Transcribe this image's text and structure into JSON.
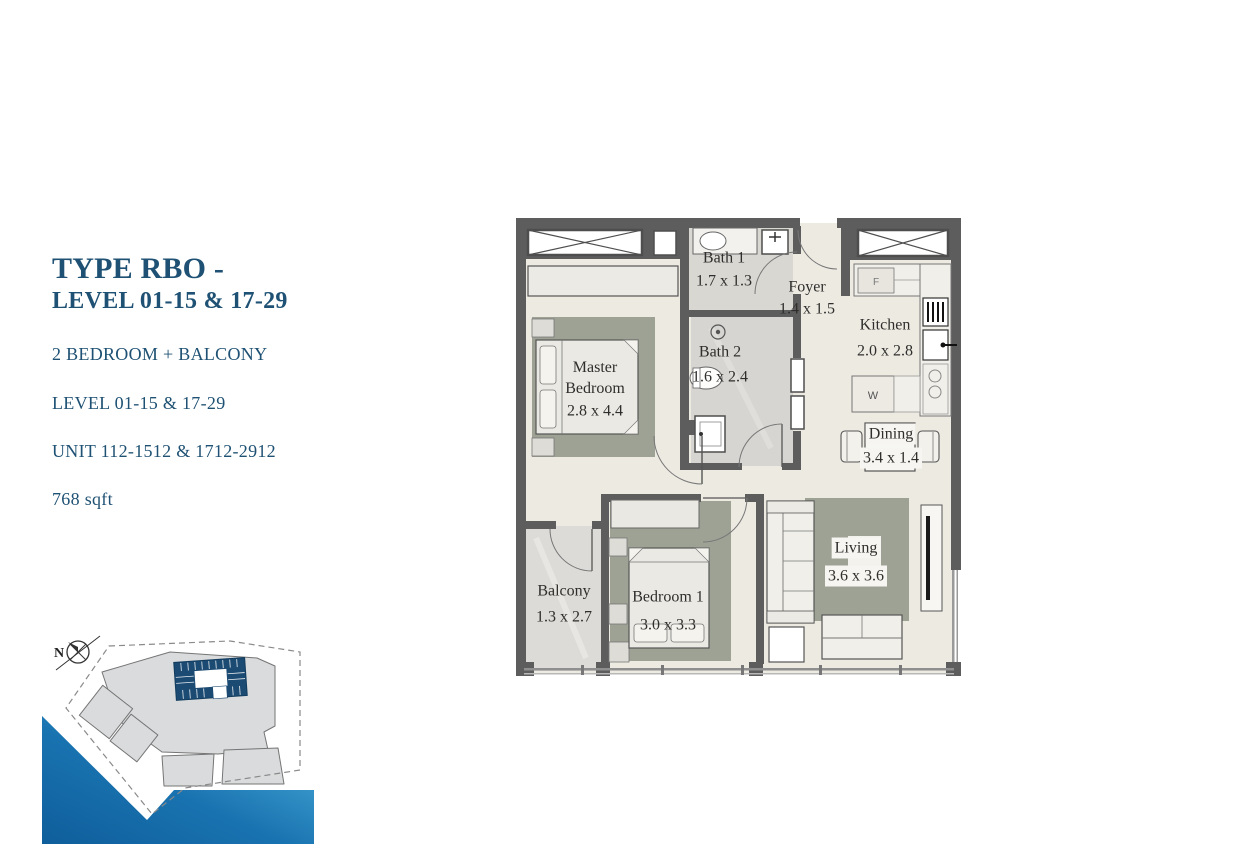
{
  "info_panel": {
    "title_line1": "TYPE RBO -",
    "title_line2": "LEVEL 01-15 & 17-29",
    "subtitle": "2 BEDROOM + BALCONY",
    "level": "LEVEL 01-15 & 17-29",
    "unit": "UNIT 112-1512 & 1712-2912",
    "area": "768 sqft"
  },
  "floor_plan": {
    "rooms": [
      {
        "name": "Master Bedroom",
        "dims": "2.8 x 4.4"
      },
      {
        "name": "Bath 1",
        "dims": "1.7 x 1.3"
      },
      {
        "name": "Bath 2",
        "dims": "1.6 x 2.4"
      },
      {
        "name": "Foyer",
        "dims": "1.4 x 1.5"
      },
      {
        "name": "Kitchen",
        "dims": "2.0 x 2.8"
      },
      {
        "name": "Dining",
        "dims": "3.4 x 1.4"
      },
      {
        "name": "Living",
        "dims": "3.6 x 3.6"
      },
      {
        "name": "Bedroom 1",
        "dims": "3.0 x 3.3"
      },
      {
        "name": "Balcony",
        "dims": "1.3 x 2.7"
      }
    ],
    "appliances": {
      "fridge": "F",
      "washer": "W"
    }
  },
  "site_map": {
    "compass": "N"
  },
  "colors": {
    "accent_blue": "#1E5173",
    "wall_gray": "#5d5d5d",
    "rug_green_gray": "#9da295",
    "highlight_navy": "#1b4a72",
    "water_dark": "#0e5e9b",
    "water_light": "#54b6e2"
  }
}
